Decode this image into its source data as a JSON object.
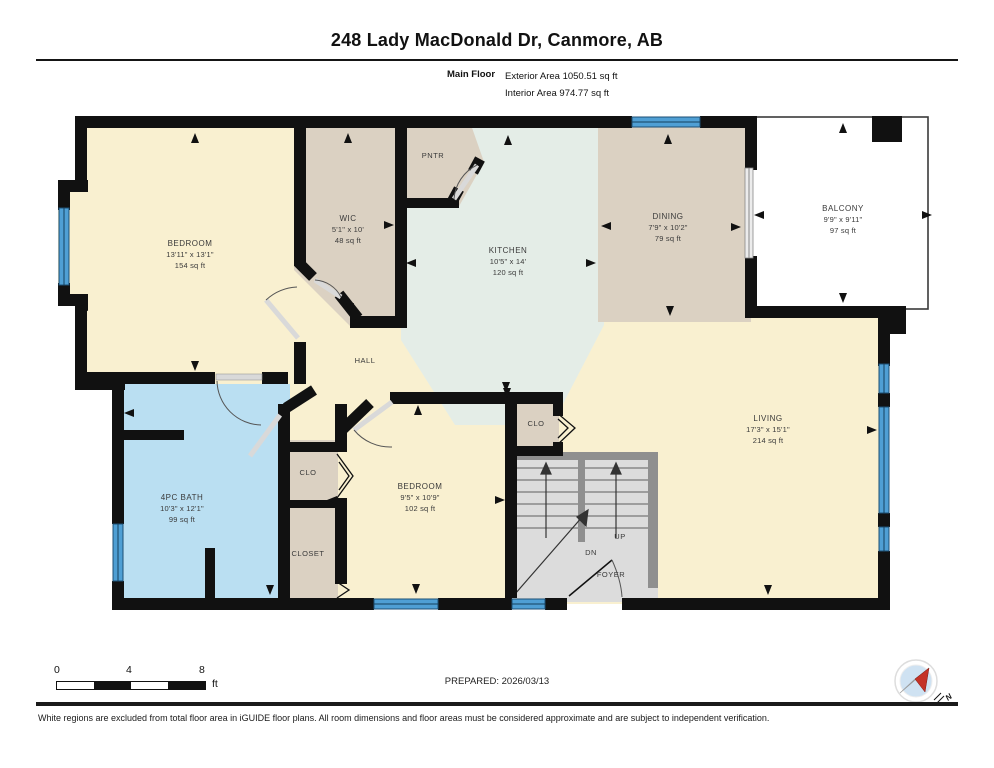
{
  "header": {
    "title": "248 Lady MacDonald Dr, Canmore, AB",
    "floor_label": "Main Floor",
    "exterior_area": "Exterior Area 1050.51 sq ft",
    "interior_area": "Interior Area 974.77 sq ft"
  },
  "rooms": {
    "bedroom1": {
      "name": "BEDROOM",
      "dims": "13'11\" x 13'1\"",
      "area": "154 sq ft"
    },
    "wic": {
      "name": "WIC",
      "dims": "5'1\" x 10'",
      "area": "48 sq ft"
    },
    "kitchen": {
      "name": "KITCHEN",
      "dims": "10'5\" x 14'",
      "area": "120 sq ft"
    },
    "dining": {
      "name": "DINING",
      "dims": "7'9\" x 10'2\"",
      "area": "79 sq ft"
    },
    "balcony": {
      "name": "BALCONY",
      "dims": "9'9\" x 9'11\"",
      "area": "97 sq ft"
    },
    "living": {
      "name": "LIVING",
      "dims": "17'3\" x 15'1\"",
      "area": "214 sq ft"
    },
    "bath": {
      "name": "4PC BATH",
      "dims": "10'3\" x 12'1\"",
      "area": "99 sq ft"
    },
    "bedroom2": {
      "name": "BEDROOM",
      "dims": "9'5\" x 10'9\"",
      "area": "102 sq ft"
    }
  },
  "small_labels": {
    "hall": "HALL",
    "pntr": "PNTR",
    "clo_bath": "CLO",
    "closet": "CLOSET",
    "clo_stairs": "CLO",
    "up": "UP",
    "dn": "DN",
    "foyer": "FOYER"
  },
  "scale_bar": {
    "t0": "0",
    "t1": "4",
    "t2": "8",
    "unit": "ft"
  },
  "footer": {
    "prepared": "PREPARED: 2026/03/13",
    "disclaimer": "White regions are excluded from total floor area in iGUIDE floor plans. All room dimensions and floor areas must be considered approximate and are subject to independent verification.",
    "north": "N"
  },
  "colors": {
    "wall": "#111111",
    "cream": "#f9f0d0",
    "tan": "#dbd1c2",
    "mint": "#e4ede7",
    "bath_blue": "#badff2",
    "stairs_gray": "#dcdcdc",
    "window_blue": "#4f9fd4",
    "compass_red": "#c43227",
    "compass_blue": "#cfe2f2"
  }
}
